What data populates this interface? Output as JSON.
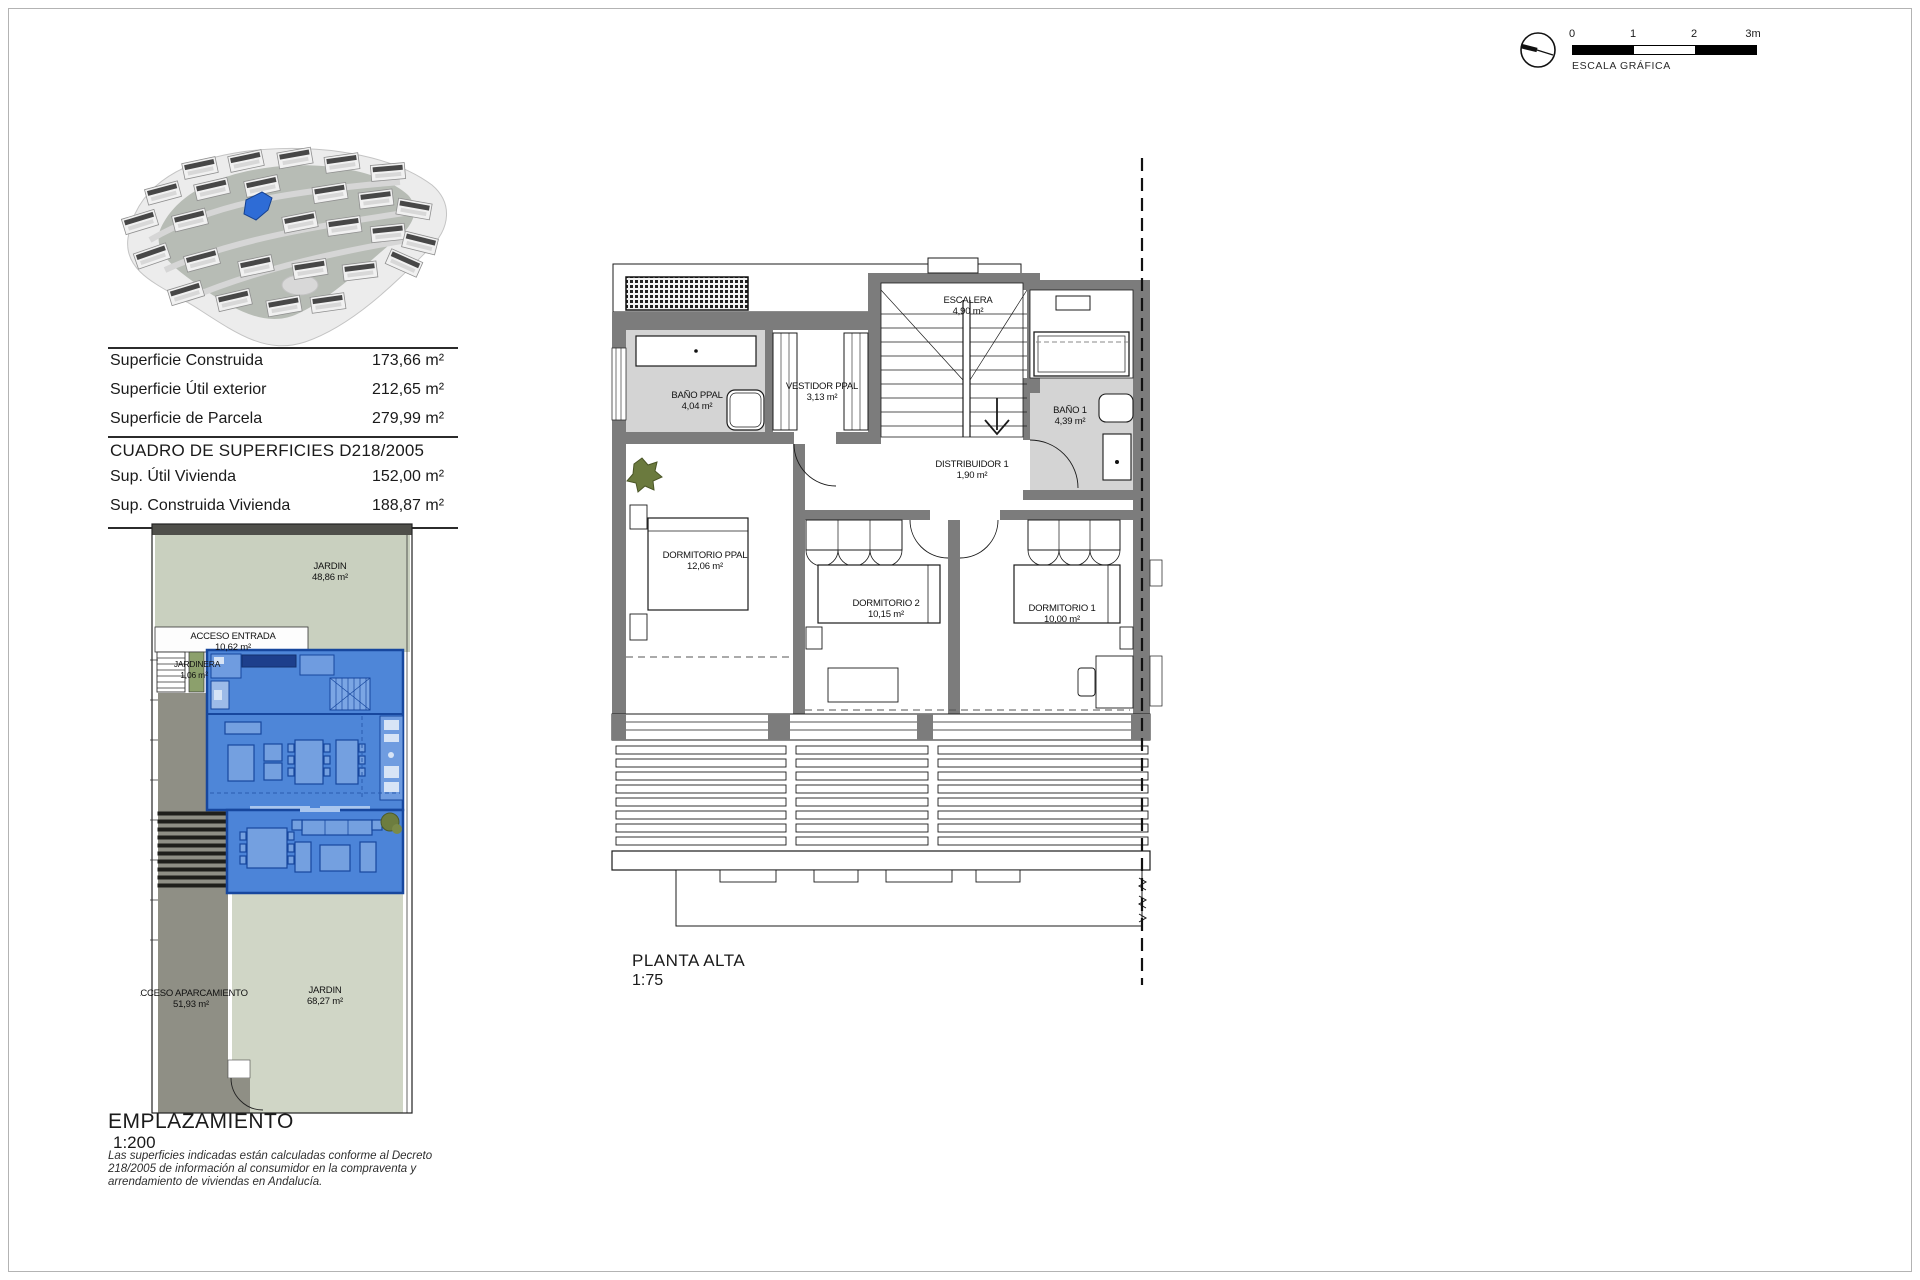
{
  "scale_graphic": {
    "tick0": "0",
    "tick1": "1",
    "tick2": "2",
    "tick3": "3m",
    "label": "ESCALA GRÁFICA"
  },
  "summary_table": {
    "rows": [
      {
        "label": "Superficie Construida",
        "value": "173,66 m²"
      },
      {
        "label": "Superficie Útil exterior",
        "value": "212,65 m²"
      },
      {
        "label": "Superficie de Parcela",
        "value": "279,99 m²"
      }
    ],
    "section_title": "CUADRO DE SUPERFICIES D218/2005",
    "rows2": [
      {
        "label": "Sup. Útil Vivienda",
        "value": "152,00 m²"
      },
      {
        "label": "Sup. Construida Vivienda",
        "value": "188,87 m²"
      }
    ]
  },
  "site_plan": {
    "title": "EMPLAZAMIENTO",
    "scale": "1:200",
    "jardin_top": {
      "name": "JARDIN",
      "area": "48,86 m²"
    },
    "acceso_entrada": {
      "name": "ACCESO ENTRADA",
      "area": "10,62 m²"
    },
    "jardinera": {
      "name": "JARDINERA",
      "area": "1,06 m²"
    },
    "acceso_aparcamiento": {
      "name": "ACCESO APARCAMIENTO",
      "area": "51,93 m²"
    },
    "jardin_bottom": {
      "name": "JARDIN",
      "area": "68,27 m²"
    }
  },
  "floor_plan": {
    "title": "PLANTA ALTA",
    "scale": "1:75",
    "escalera": {
      "name": "ESCALERA",
      "area": "4,90 m²"
    },
    "bano_ppal": {
      "name": "BAÑO PPAL",
      "area": "4,04 m²"
    },
    "vestidor_ppal": {
      "name": "VESTIDOR PPAL",
      "area": "3,13 m²"
    },
    "bano_1": {
      "name": "BAÑO 1",
      "area": "4,39 m²"
    },
    "distribuidor_1": {
      "name": "DISTRIBUIDOR 1",
      "area": "1,90 m²"
    },
    "dormitorio_ppal": {
      "name": "DORMITORIO PPAL",
      "area": "12,06 m²"
    },
    "dormitorio_2": {
      "name": "DORMITORIO 2",
      "area": "10,15 m²"
    },
    "dormitorio_1": {
      "name": "DORMITORIO 1",
      "area": "10,00 m²"
    }
  },
  "disclaimer": "Las superficies indicadas están calculadas conforme al Decreto 218/2005 de información al consumidor en la compraventa y arrendamiento de viviendas en Andalucía.",
  "colors": {
    "highlight_blue": "#4e86d8",
    "plan_wall_gray": "#7c7c7c",
    "garden_green": "#cbd2c0",
    "access_gray": "#8f8f85"
  }
}
